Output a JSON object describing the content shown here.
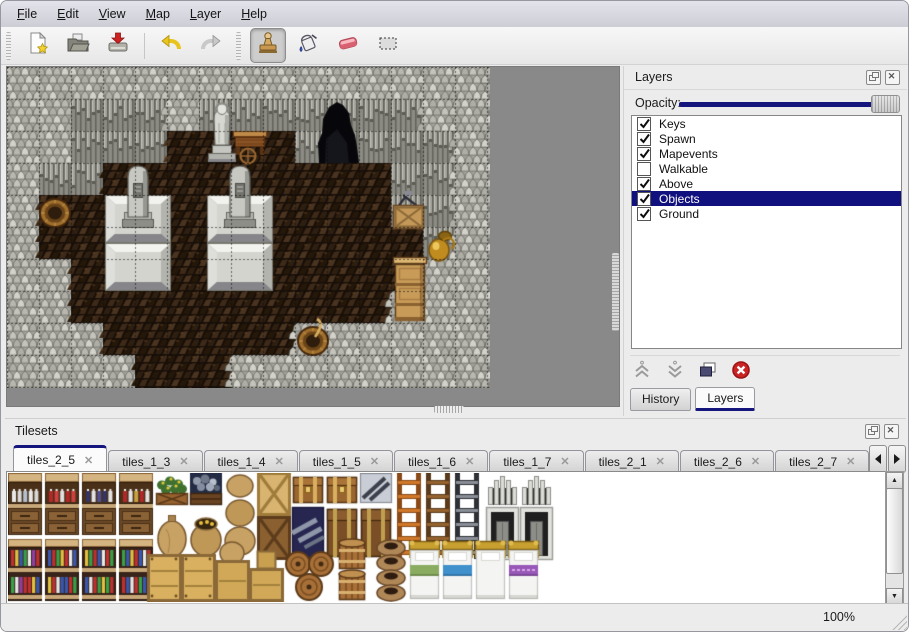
{
  "menu": {
    "items": [
      {
        "label": "File"
      },
      {
        "label": "Edit"
      },
      {
        "label": "View"
      },
      {
        "label": "Map"
      },
      {
        "label": "Layer"
      },
      {
        "label": "Help"
      }
    ]
  },
  "toolbar": {
    "buttons": [
      {
        "name": "new",
        "icon": "new-file-icon",
        "active": false
      },
      {
        "name": "open",
        "icon": "open-folder-icon",
        "active": false
      },
      {
        "name": "save",
        "icon": "save-icon",
        "active": false
      },
      {
        "name": "undo",
        "icon": "undo-icon",
        "active": false
      },
      {
        "name": "redo",
        "icon": "redo-icon",
        "active": false
      },
      {
        "name": "stamp",
        "icon": "stamp-tool-icon",
        "active": true
      },
      {
        "name": "fill",
        "icon": "fill-bucket-icon",
        "active": false
      },
      {
        "name": "eraser",
        "icon": "eraser-icon",
        "active": false
      },
      {
        "name": "select",
        "icon": "select-rect-icon",
        "active": false
      }
    ]
  },
  "layers_panel": {
    "title": "Layers",
    "opacity_label": "Opacity:",
    "opacity_percent": 100,
    "accent_color": "#15157e",
    "selection_color": "#10107e",
    "layers": [
      {
        "name": "Keys",
        "checked": true,
        "selected": false
      },
      {
        "name": "Spawn",
        "checked": true,
        "selected": false
      },
      {
        "name": "Mapevents",
        "checked": true,
        "selected": false
      },
      {
        "name": "Walkable",
        "checked": false,
        "selected": false
      },
      {
        "name": "Above",
        "checked": true,
        "selected": false
      },
      {
        "name": "Objects",
        "checked": true,
        "selected": true
      },
      {
        "name": "Ground",
        "checked": true,
        "selected": false
      }
    ],
    "action_icons": [
      "move-up-icon",
      "move-down-icon",
      "duplicate-layer-icon",
      "delete-layer-icon"
    ],
    "tabs": [
      {
        "label": "History",
        "active": false
      },
      {
        "label": "Layers",
        "active": true
      }
    ]
  },
  "tilesets_panel": {
    "title": "Tilesets",
    "tabs": [
      {
        "label": "tiles_2_5",
        "active": true
      },
      {
        "label": "tiles_1_3",
        "active": false
      },
      {
        "label": "tiles_1_4",
        "active": false
      },
      {
        "label": "tiles_1_5",
        "active": false
      },
      {
        "label": "tiles_1_6",
        "active": false
      },
      {
        "label": "tiles_1_7",
        "active": false
      },
      {
        "label": "tiles_2_1",
        "active": false
      },
      {
        "label": "tiles_2_6",
        "active": false
      },
      {
        "label": "tiles_2_7",
        "active": false
      },
      {
        "label": "tiles_",
        "active": false,
        "partial": true
      }
    ]
  },
  "status_bar": {
    "zoom_level": "100%"
  },
  "map_view": {
    "tile_size": 32,
    "legend": {
      "R": "rock",
      "W": "wall-face",
      "F": "floor"
    },
    "palette": {
      "rock": "#aeaea6",
      "wall": "#8e8e86",
      "floor": "#2a1c12",
      "grid": "rgba(10,10,10,0.55)"
    },
    "grid": [
      "RRRRRRRRRRRRRRR",
      "RRWWWRWWWWWWWRR",
      "RRWWWFFFFWWWWWR",
      "RWWFFFFFFFFFWWR",
      "RFFFFFFFFFFFWWR",
      "RFFFFFFFFFFFFWR",
      "RRFFFFFFFFFFFRR",
      "RRFFFFFFFFFFRRR",
      "RRRFFFFFFRRRRRR",
      "RRRRFFFRRRRRRRR"
    ],
    "objects": [
      {
        "type": "platform",
        "x": 98,
        "y": 128
      },
      {
        "type": "platform",
        "x": 200,
        "y": 128
      },
      {
        "type": "gravestone",
        "x": 114,
        "y": 96
      },
      {
        "type": "gravestone",
        "x": 216,
        "y": 96
      },
      {
        "type": "statue",
        "x": 198,
        "y": 30
      },
      {
        "type": "table-cart",
        "x": 226,
        "y": 64
      },
      {
        "type": "cave-entrance",
        "x": 306,
        "y": 32
      },
      {
        "type": "barrel-open",
        "x": 32,
        "y": 130
      },
      {
        "type": "crate-tools",
        "x": 384,
        "y": 124
      },
      {
        "type": "gold-vase",
        "x": 418,
        "y": 158
      },
      {
        "type": "cabinet",
        "x": 386,
        "y": 190
      },
      {
        "type": "barrel-stick",
        "x": 290,
        "y": 258
      }
    ]
  },
  "tileset_view": {
    "tiles": [
      {
        "type": "shelf-top",
        "variant": 0,
        "x": 0,
        "y": 0
      },
      {
        "type": "shelf-top",
        "variant": 1,
        "x": 37,
        "y": 0
      },
      {
        "type": "shelf-top",
        "variant": 2,
        "x": 74,
        "y": 0
      },
      {
        "type": "shelf-top",
        "variant": 3,
        "x": 111,
        "y": 0
      },
      {
        "type": "flower-box",
        "x": 148,
        "y": 0
      },
      {
        "type": "ore-box",
        "x": 182,
        "y": 0
      },
      {
        "type": "sack",
        "x": 148,
        "y": 34
      },
      {
        "type": "sack-open",
        "x": 182,
        "y": 34
      },
      {
        "type": "sack-stack",
        "x": 216,
        "y": 0
      },
      {
        "type": "crate-x-light",
        "x": 250,
        "y": 0
      },
      {
        "type": "crate-x-dark",
        "x": 250,
        "y": 44
      },
      {
        "type": "chest",
        "x": 284,
        "y": 0
      },
      {
        "type": "blue-pile",
        "x": 284,
        "y": 34
      },
      {
        "type": "chest",
        "x": 318,
        "y": 0
      },
      {
        "type": "chest-dark",
        "x": 318,
        "y": 34
      },
      {
        "type": "metal-beams",
        "x": 352,
        "y": 0
      },
      {
        "type": "chest-dark",
        "x": 352,
        "y": 34
      },
      {
        "type": "ladder",
        "variant": "orange",
        "x": 388,
        "y": 0
      },
      {
        "type": "ladder",
        "variant": "brown",
        "x": 417,
        "y": 0
      },
      {
        "type": "ladder",
        "variant": "gray",
        "x": 446,
        "y": 0
      },
      {
        "type": "arch-top",
        "x": 478,
        "y": 0
      },
      {
        "type": "arch-top",
        "x": 512,
        "y": 0
      },
      {
        "type": "arch-door",
        "x": 478,
        "y": 34
      },
      {
        "type": "arch-door",
        "x": 512,
        "y": 34
      },
      {
        "type": "shelf-bottom",
        "variant": 0,
        "x": 0,
        "y": 66
      },
      {
        "type": "shelf-bottom",
        "variant": 1,
        "x": 37,
        "y": 66
      },
      {
        "type": "shelf-bottom",
        "variant": 2,
        "x": 74,
        "y": 66
      },
      {
        "type": "shelf-bottom",
        "variant": 3,
        "x": 111,
        "y": 66
      },
      {
        "type": "crate-big",
        "x": 140,
        "y": 82
      },
      {
        "type": "crate-big",
        "x": 174,
        "y": 82
      },
      {
        "type": "crate-sack",
        "x": 208,
        "y": 68
      },
      {
        "type": "crate-stack",
        "x": 242,
        "y": 78
      },
      {
        "type": "barrels-pile",
        "x": 276,
        "y": 78
      },
      {
        "type": "barrels-standing",
        "x": 328,
        "y": 66
      },
      {
        "type": "pot-stack",
        "x": 366,
        "y": 66
      },
      {
        "type": "bed",
        "variant": "green",
        "x": 400,
        "y": 66
      },
      {
        "type": "bed",
        "variant": "blue",
        "x": 433,
        "y": 66
      },
      {
        "type": "bed",
        "variant": "white",
        "x": 466,
        "y": 66
      },
      {
        "type": "bed",
        "variant": "purple",
        "x": 499,
        "y": 66
      }
    ]
  }
}
